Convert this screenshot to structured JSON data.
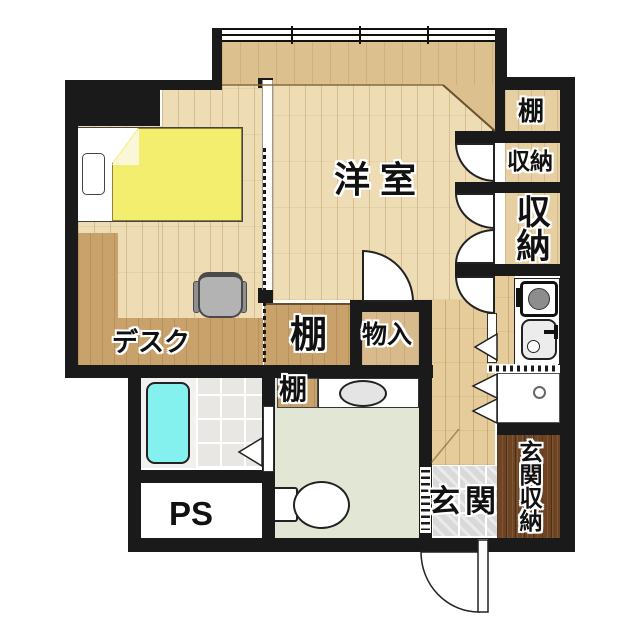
{
  "title": "apartment-floor-plan",
  "rooms": {
    "western": {
      "label": "洋室"
    },
    "shelf_top_right": {
      "label": "棚"
    },
    "storage_upper": {
      "label": "収納"
    },
    "storage_lower": {
      "label": "収納"
    },
    "shelf_middle": {
      "label": "棚"
    },
    "storage_closet": {
      "label": "物入"
    },
    "shelf_washroom": {
      "label": "棚"
    },
    "desk": {
      "label": "デスク"
    },
    "pipe_space": {
      "label": "PS"
    },
    "entrance": {
      "label": "玄関"
    },
    "entrance_storage": {
      "label": "玄関収納"
    }
  },
  "colors": {
    "wall": "#1a1a1a",
    "floor_light_wood": "#eedcb4",
    "floor_window_strip": "#dcc18f",
    "floor_hall_wood": "#e6cc9a",
    "shelf_brown": "#c8a26a",
    "closet_tan": "#d8bb8c",
    "entrance_storage_wood": "#6e4423",
    "entrance_tile": "#d9d9d9",
    "washroom_floor": "#e1e6d5",
    "bath_tile": "#e9e7e3",
    "bathtub": "#84f1ef",
    "bed_cover": "#f4ee6e"
  }
}
